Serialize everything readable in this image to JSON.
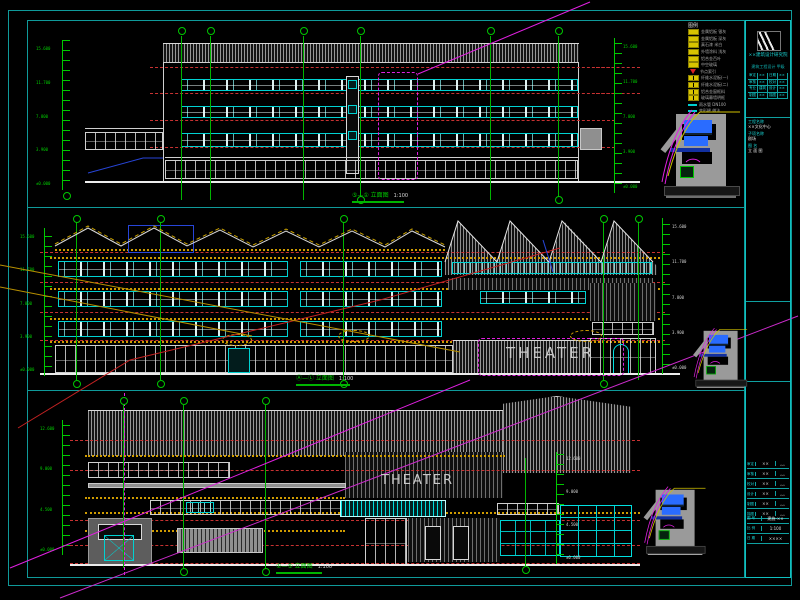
{
  "app": {
    "title": "CAD elevation sheet — theater building"
  },
  "colors": {
    "background": "#000000",
    "frame_cyan": "#0f9a9a",
    "grid_green": "#00c800",
    "level_red": "#c83232",
    "sill_yellow": "#cf9b00",
    "window_cyan": "#00d2d2",
    "revision_magenta": "#e020e0",
    "detail_blue": "#2a6cff",
    "wall_gray": "#8f8f8f"
  },
  "panels": [
    {
      "label": "⑤—① 立面图",
      "scale": "1:100",
      "levels": [
        "15.600",
        "11.700",
        "7.800",
        "3.900",
        "±0.000"
      ]
    },
    {
      "label": "Ⓐ—Ⓛ 立面图",
      "scale": "1:100",
      "theater": "THEATER",
      "levels": [
        "15.600",
        "11.700",
        "7.800",
        "3.900",
        "±0.000"
      ]
    },
    {
      "label": "①—⑤ 立面图",
      "scale": "1:100",
      "theater": "THEATER",
      "levels": [
        "12.600",
        "9.000",
        "4.500",
        "±0.000"
      ]
    }
  ],
  "legend": {
    "title": "图例",
    "items": [
      {
        "sw": "y",
        "label": "金属铝板 银灰"
      },
      {
        "sw": "y",
        "label": "金属铝板 深灰"
      },
      {
        "sw": "y",
        "label": "真石漆 米白"
      },
      {
        "sw": "y",
        "label": "外墙涂料 浅灰"
      },
      {
        "sw": "y",
        "label": "铝合金百叶"
      },
      {
        "sw": "y",
        "label": "中空玻璃"
      },
      {
        "sw": "red",
        "label": "节点索引"
      },
      {
        "sw": "yy",
        "label": "纤维水泥板(一)"
      },
      {
        "sw": "yy",
        "label": "纤维水泥板(二)"
      },
      {
        "sw": "yy",
        "label": "铝合金窗框料"
      },
      {
        "sw": "yy",
        "label": "玻璃幕墙明框"
      },
      {
        "sw": "cy",
        "label": "雨水管 DN100"
      },
      {
        "sw": "cy",
        "label": "变形缝 做法"
      },
      {
        "sw": "wt",
        "label": "立面照明灯具"
      }
    ]
  },
  "titleblock": {
    "company": "××建筑设计研究院",
    "cert": "建筑工程设计 甲级",
    "grid_rows": [
      [
        "审定",
        "××",
        "日期",
        "××"
      ],
      [
        "审核",
        "××",
        "校对",
        "××"
      ],
      [
        "专业",
        "建筑",
        "设计",
        "××"
      ],
      [
        "制图",
        "××",
        "描图",
        "××"
      ]
    ],
    "cells": [
      {
        "k": "工程名称",
        "v": "××文化中心"
      },
      {
        "k": "子项名称",
        "v": "剧场"
      },
      {
        "k": "图  名",
        "v": "立 面 图"
      }
    ],
    "rev_rows": [
      [
        "审定",
        "××",
        "﹏"
      ],
      [
        "审核",
        "××",
        "﹏"
      ],
      [
        "校对",
        "××",
        "﹏"
      ],
      [
        "设计",
        "××",
        "﹏"
      ],
      [
        "制图",
        "××",
        "﹏"
      ],
      [
        "描图",
        "××",
        "﹏"
      ]
    ],
    "bottom": [
      [
        "图 号",
        "建施-××"
      ],
      [
        "比 例",
        "1:100"
      ],
      [
        "日 期",
        "××××"
      ]
    ]
  }
}
